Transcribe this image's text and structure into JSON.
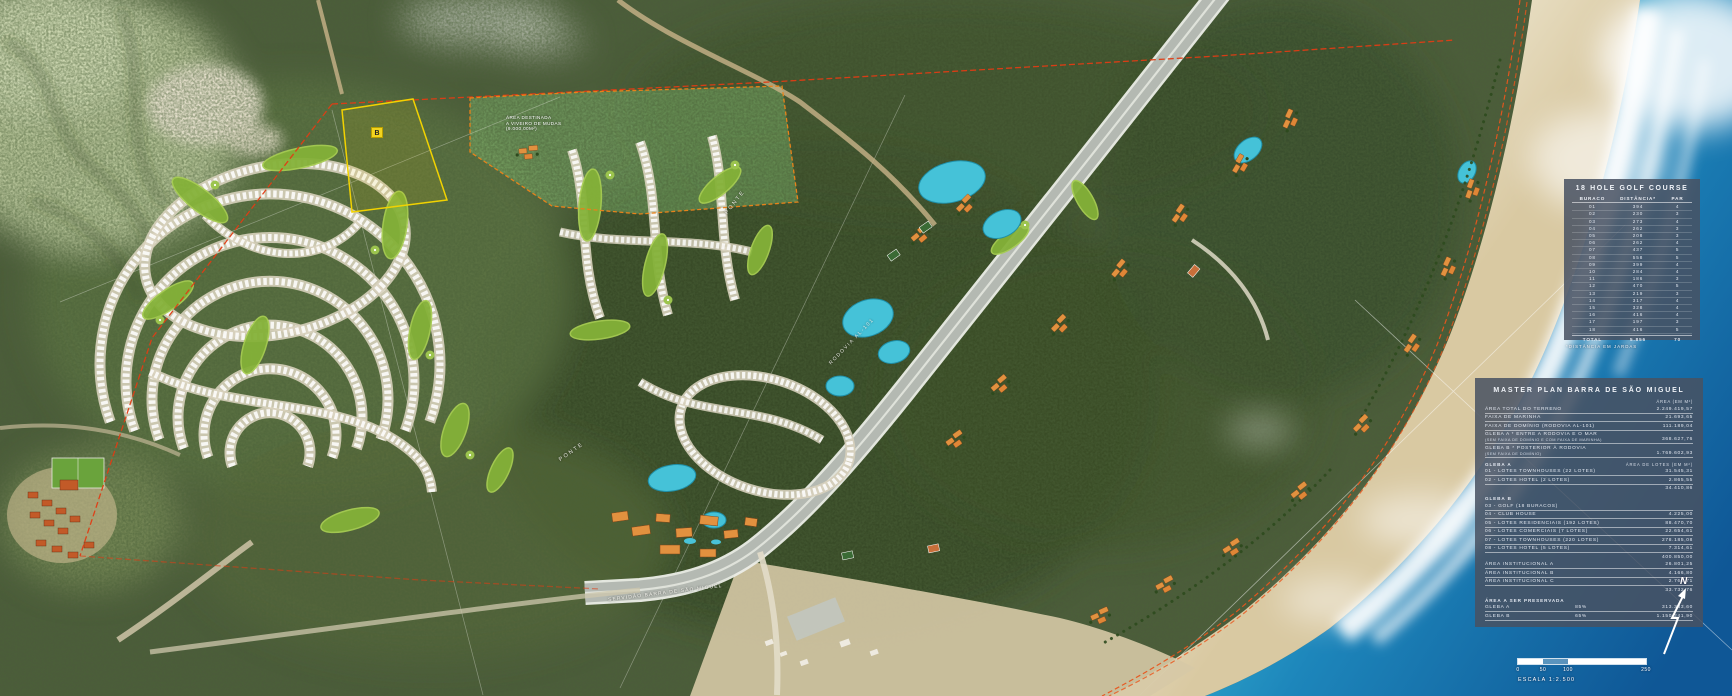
{
  "colors": {
    "boundary_red": "#e03c14",
    "parcel_yellow": "#f2d200",
    "panel_bg": "#485262",
    "ocean_deep": "#0f5796",
    "ocean_shallow": "#3bbcd6"
  },
  "map_labels": {
    "viveiro": [
      "ÁREA DESTINADA",
      "A VIVEIRO DE MUDAS",
      "(9.000,00M²)"
    ],
    "parcel_b": "B",
    "ponte_1": "PONTE",
    "ponte_2": "PONTE",
    "rodovia": "RODOVIA AL-101",
    "servidao": "SERVIDÃO BARRA DE SÃO MIGUEL",
    "north": "N"
  },
  "scalebar": {
    "ticks": [
      "0",
      "50",
      "100",
      "250"
    ],
    "label": "ESCALA 1:2.500"
  },
  "golf": {
    "title": "18 HOLE GOLF COURSE",
    "columns": {
      "hole": "BURACO",
      "distance": "DISTÂNCIA*",
      "par": "PAR"
    },
    "rows": [
      {
        "h": "01",
        "d": "394",
        "p": "4"
      },
      {
        "h": "02",
        "d": "230",
        "p": "3"
      },
      {
        "h": "03",
        "d": "273",
        "p": "4"
      },
      {
        "h": "04",
        "d": "262",
        "p": "3"
      },
      {
        "h": "05",
        "d": "208",
        "p": "3"
      },
      {
        "h": "06",
        "d": "262",
        "p": "4"
      },
      {
        "h": "07",
        "d": "437",
        "p": "5"
      },
      {
        "h": "08",
        "d": "558",
        "p": "5"
      },
      {
        "h": "09",
        "d": "399",
        "p": "4"
      },
      {
        "h": "10",
        "d": "284",
        "p": "4"
      },
      {
        "h": "11",
        "d": "186",
        "p": "3"
      },
      {
        "h": "12",
        "d": "470",
        "p": "5"
      },
      {
        "h": "13",
        "d": "219",
        "p": "3"
      },
      {
        "h": "14",
        "d": "317",
        "p": "4"
      },
      {
        "h": "15",
        "d": "328",
        "p": "4"
      },
      {
        "h": "16",
        "d": "416",
        "p": "4"
      },
      {
        "h": "17",
        "d": "197",
        "p": "3"
      },
      {
        "h": "18",
        "d": "416",
        "p": "5"
      }
    ],
    "total": {
      "label": "TOTAL",
      "d": "5.856",
      "p": "70"
    },
    "footnote": "*DISTÂNCIA EM JARDAS"
  },
  "master": {
    "title": "MASTER PLAN BARRA DE SÃO MIGUEL",
    "area_header": "ÁREA (EM M²)",
    "area_total": {
      "label": "ÁREA TOTAL DO TERRENO",
      "value": "2.249.419,57"
    },
    "faixa_marinha": {
      "label": "FAIXA DE MARINHA",
      "value": "21.693,65"
    },
    "faixa_dominio": {
      "label": "FAIXA DE DOMÍNIO (RODOVIA AL-101)",
      "value": "111.189,04"
    },
    "gleba_a": {
      "label": "GLEBA A * ENTRE A RODOVIA E O MAR",
      "sub": "(SEM FAIXA DE DOMÍNIO E COM FAIXA DE MARINHA)",
      "value": "368.627,76"
    },
    "gleba_b": {
      "label": "GLEBA B * POSTERIOR À RODOVIA",
      "sub": "(SEM FAIXA DE DOMÍNIO)",
      "value": "1.769.602,93"
    },
    "sec_a": {
      "header": "GLEBA A",
      "area_header": "ÁREA DE LOTES (EM M²)",
      "r1": {
        "label": "01 - LOTES TOWNHOUSES (22 LOTES)",
        "value": "31.545,31"
      },
      "r2": {
        "label": "02 - LOTES HOTEL (2 LOTES)",
        "value": "2.865,55"
      },
      "subtotal": "34.410,86"
    },
    "sec_b": {
      "header": "GLEBA B",
      "r3": {
        "label": "03 - GOLF (18 BURACOS)",
        "value": ""
      },
      "r4": {
        "label": "04 - CLUB HOUSE",
        "value": "4.225,00"
      },
      "r5": {
        "label": "05 - LOTES RESIDENCIAIS (192 LOTES)",
        "value": "88.470,70"
      },
      "r6": {
        "label": "06 - LOTES COMERCIAIS (7 LOTES)",
        "value": "22.654,61"
      },
      "r7": {
        "label": "07 - LOTES TOWNHOUSES (220 LOTES)",
        "value": "278.185,08"
      },
      "r8": {
        "label": "08 - LOTES HOTEL (5 LOTES)",
        "value": "7.314,61"
      },
      "subtotal": "400.850,00"
    },
    "inst": {
      "a": {
        "label": "ÁREA INSTITUCIONAL A",
        "value": "26.801,25"
      },
      "b": {
        "label": "ÁREA INSTITUCIONAL B",
        "value": "4.166,80"
      },
      "c": {
        "label": "ÁREA INSTITUCIONAL C",
        "value": "2.764,71"
      },
      "subtotal": "33.732,76"
    },
    "preservada": {
      "header": "ÁREA A SER PRESERVADA",
      "ga": {
        "label": "GLEBA A",
        "pct": "85%",
        "value": "313.333,60"
      },
      "gb": {
        "label": "GLEBA B",
        "pct": "65%",
        "value": "1.150.241,90"
      }
    }
  }
}
